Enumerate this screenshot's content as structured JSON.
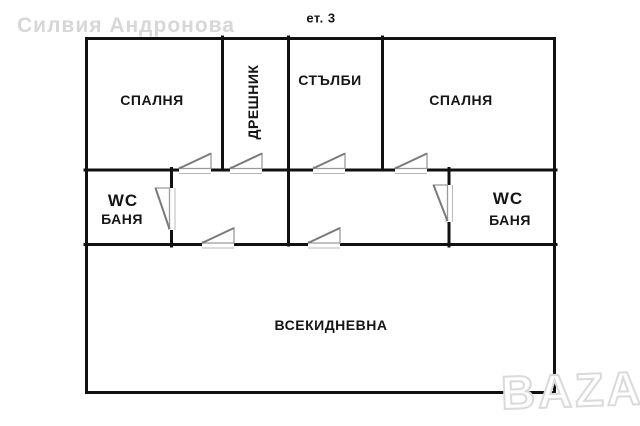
{
  "floor_label": "ет. 3",
  "watermark": {
    "name": "Силвия Андронова",
    "logo": "BAZAR"
  },
  "rooms": {
    "bedroom_left": "СПАЛНЯ",
    "closet": "ДРЕШНИК",
    "stairs": "СТЪЛБИ",
    "bedroom_right": "СПАЛНЯ",
    "wc_left": {
      "title": "WC",
      "subtitle": "БАНЯ"
    },
    "wc_right": {
      "title": "WC",
      "subtitle": "БАНЯ"
    },
    "living_room": "ВСЕКИДНЕВНА"
  },
  "colors": {
    "wall": "#111111",
    "door": "#9a9a9a",
    "door_leaf": "#7a7a7a",
    "watermark": "#d7d7d7"
  }
}
